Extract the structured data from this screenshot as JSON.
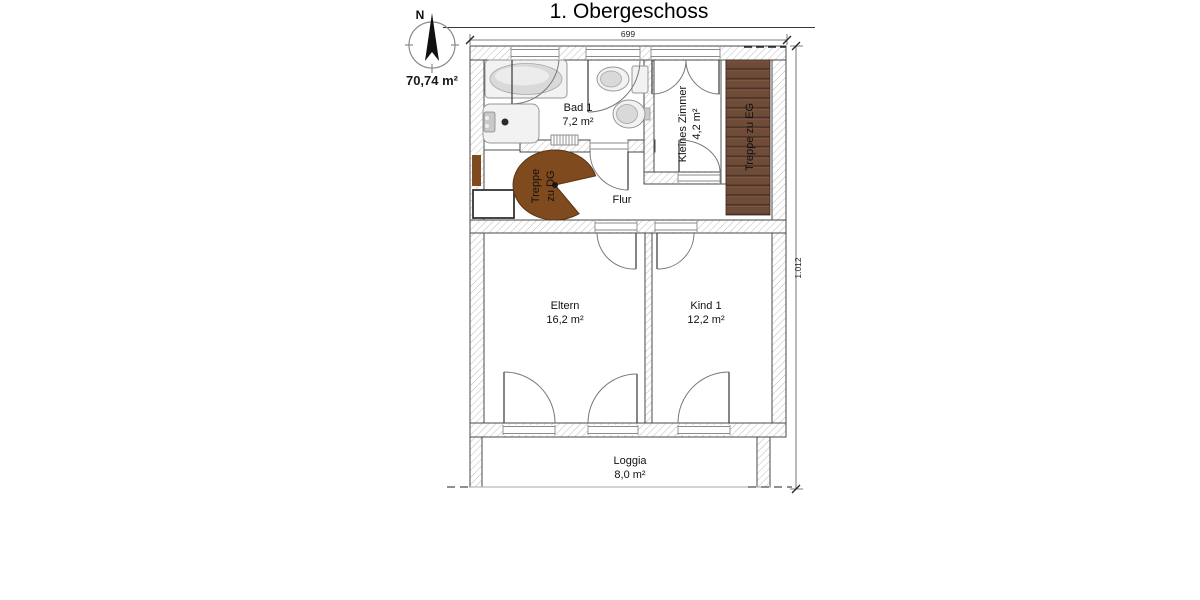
{
  "title": "1. Obergeschoss",
  "compass": {
    "north_label": "N",
    "total_area": "70,74 m²"
  },
  "dimensions": {
    "top_width": "699",
    "right_height": "1.012"
  },
  "rooms": {
    "bad": {
      "name": "Bad 1",
      "area": "7,2 m²"
    },
    "kleines_zimmer": {
      "name": "Kleines Zimmer",
      "area": "4,2 m²"
    },
    "flur": {
      "name": "Flur"
    },
    "eltern": {
      "name": "Eltern",
      "area": "16,2 m²"
    },
    "kind": {
      "name": "Kind 1",
      "area": "12,2 m²"
    },
    "loggia": {
      "name": "Loggia",
      "area": "8,0 m²"
    }
  },
  "stairs": {
    "to_dg_line1": "Treppe",
    "to_dg_line2": "zu DG",
    "to_eg": "Treppe zu EG"
  },
  "colors": {
    "spiral_stair": "#7f4a1d",
    "wood_stair": "#6f4c38",
    "wood_stair_shadow": "#4a3328",
    "wall_outline": "#4a4a4a",
    "hatch_line": "#bcbcbc"
  }
}
